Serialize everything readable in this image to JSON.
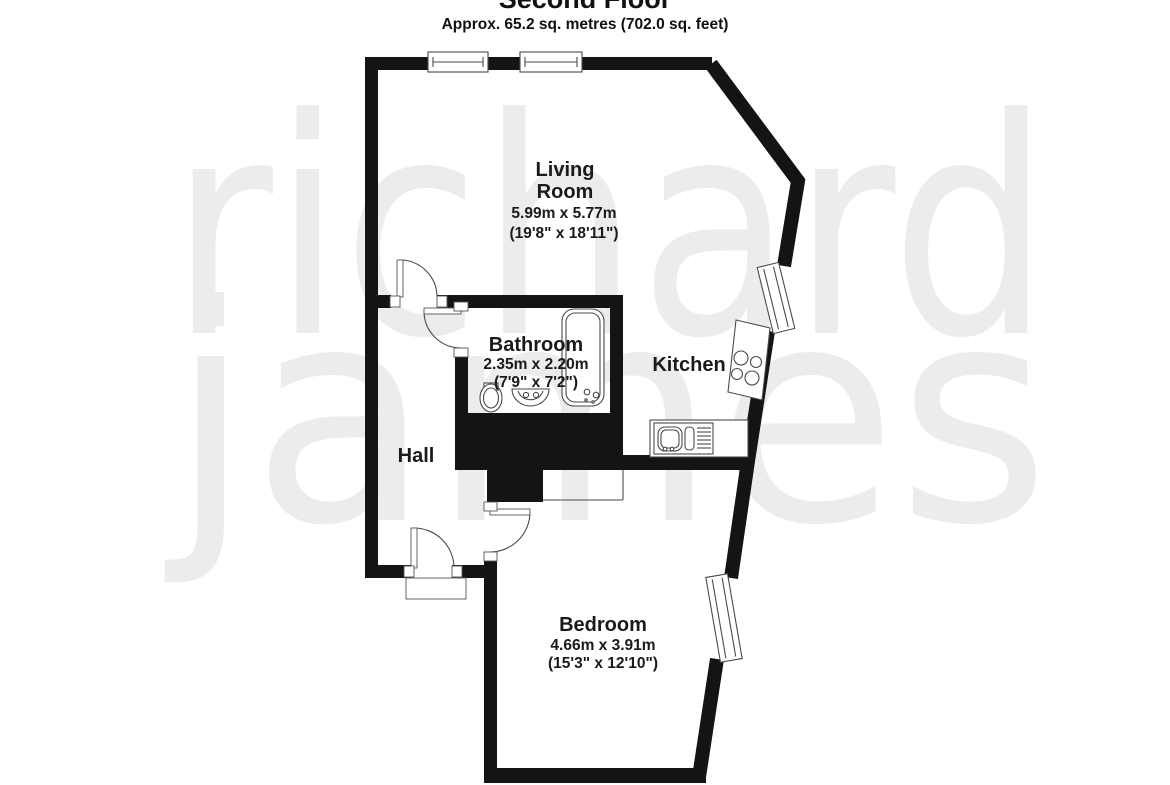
{
  "header": {
    "title": "Second Floor",
    "subtitle": "Approx. 65.2 sq. metres (702.0 sq. feet)"
  },
  "watermark": {
    "line1": "richard",
    "line2": "james"
  },
  "rooms": {
    "living_room": {
      "name_line1": "Living",
      "name_line2": "Room",
      "metric": "5.99m x 5.77m",
      "imperial": "(19'8\" x 18'11\")"
    },
    "bathroom": {
      "name": "Bathroom",
      "metric": "2.35m x 2.20m",
      "imperial": "(7'9\" x 7'2\")"
    },
    "kitchen": {
      "name": "Kitchen"
    },
    "hall": {
      "name": "Hall"
    },
    "bedroom": {
      "name": "Bedroom",
      "metric": "4.66m x 3.91m",
      "imperial": "(15'3\" x 12'10\")"
    }
  },
  "colors": {
    "wall": "#141414",
    "thin_line": "#4a4a4a",
    "watermark": "#ececec",
    "background": "#ffffff",
    "text": "#111111"
  }
}
